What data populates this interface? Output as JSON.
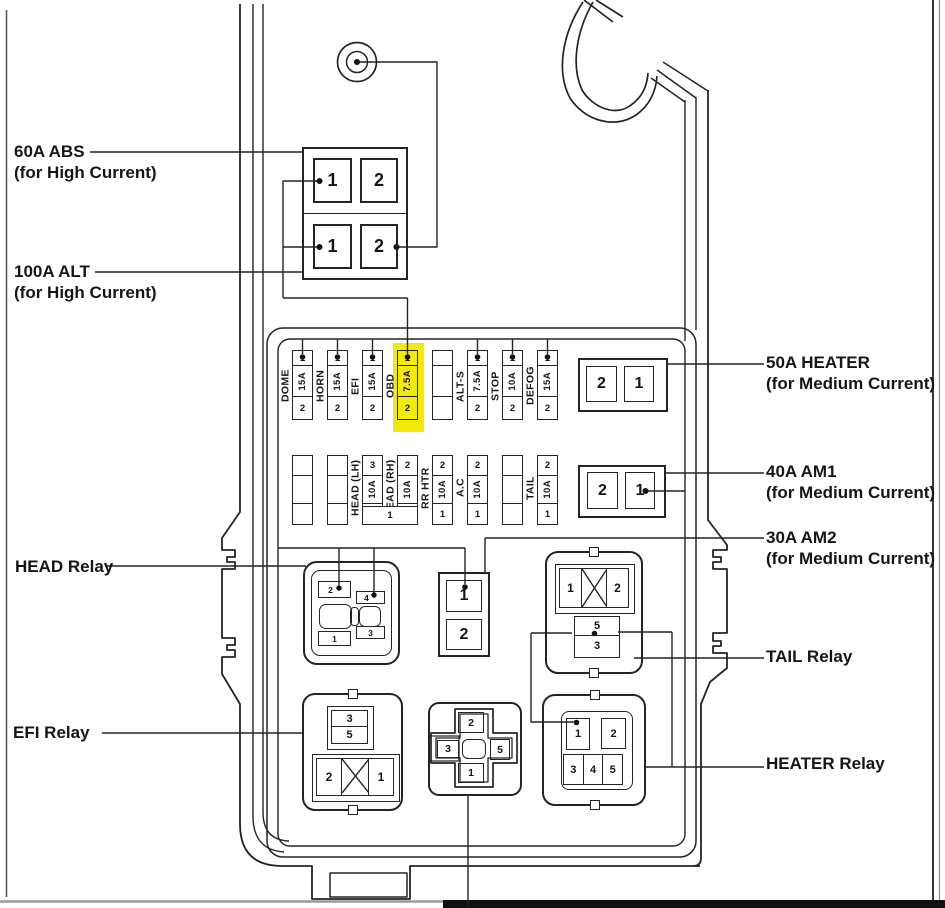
{
  "colors": {
    "highlight": "#f2e90e",
    "line": "#242424",
    "paper": "#ffffff"
  },
  "side_labels": {
    "abs_title": "60A ABS",
    "abs_sub": "(for High Current)",
    "alt_title": "100A ALT",
    "alt_sub": "(for High Current)",
    "heater50_title": "50A HEATER",
    "heater50_sub": "(for Medium Current)",
    "am1_title": "40A AM1",
    "am1_sub": "(for Medium Current)",
    "am2_title": "30A AM2",
    "am2_sub": "(for Medium Current)",
    "head_relay": "HEAD Relay",
    "efi_relay": "EFI Relay",
    "tail_relay": "TAIL Relay",
    "heater_relay": "HEATER Relay"
  },
  "high_current_block": {
    "r1c1": "1",
    "r1c2": "2",
    "r2c1": "1",
    "r2c2": "2"
  },
  "fuse_row_top": [
    {
      "name": "DOME",
      "top": "1",
      "amp": "15A",
      "bottom": "2"
    },
    {
      "name": "HORN",
      "top": "1",
      "amp": "15A",
      "bottom": "2"
    },
    {
      "name": "EFI",
      "top": "1",
      "amp": "15A",
      "bottom": "2"
    },
    {
      "name": "OBD",
      "top": "1",
      "amp": "7.5A",
      "bottom": "2",
      "highlighted": true
    },
    {
      "name": "",
      "top": "",
      "amp": "",
      "bottom": ""
    },
    {
      "name": "ALT-S",
      "top": "1",
      "amp": "7.5A",
      "bottom": "2"
    },
    {
      "name": "STOP",
      "top": "1",
      "amp": "10A",
      "bottom": "2"
    },
    {
      "name": "DEFOG",
      "top": "1",
      "amp": "15A",
      "bottom": "2"
    }
  ],
  "fuse_row_bottom": [
    {
      "name": "",
      "top": "",
      "amp": "",
      "bottom": ""
    },
    {
      "name": "",
      "top": "",
      "amp": "",
      "bottom": ""
    },
    {
      "name": "HEAD (LH)",
      "top": "3",
      "amp": "10A",
      "bottom": ""
    },
    {
      "name": "HEAD (RH)",
      "top": "2",
      "amp": "10A",
      "bottom": ""
    },
    {
      "name": "RR HTR",
      "top": "2",
      "amp": "10A",
      "bottom": "1"
    },
    {
      "name": "A.C",
      "top": "2",
      "amp": "10A",
      "bottom": "1"
    },
    {
      "name": "",
      "top": "",
      "amp": "",
      "bottom": ""
    },
    {
      "name": "TAIL",
      "top": "2",
      "amp": "10A",
      "bottom": "1"
    }
  ],
  "shared_head_fuse_pin": "1",
  "medium_blocks": {
    "heater50": {
      "left": "2",
      "right": "1"
    },
    "am1": {
      "left": "2",
      "right": "1"
    },
    "am2": {
      "top": "1",
      "bottom": "2"
    }
  },
  "head_relay": {
    "p2": "2",
    "p4": "4",
    "p1": "1",
    "p3": "3"
  },
  "tail_relay": {
    "left": "1",
    "right": "2",
    "coil_top": "5",
    "coil_bottom": "3"
  },
  "efi_relay": {
    "coil_top": "3",
    "coil_bottom": "5",
    "left": "2",
    "right": "1"
  },
  "cross_relay": {
    "top": "2",
    "left": "3",
    "right": "5",
    "bottom": "1"
  },
  "heater_relay": {
    "p1": "1",
    "p2": "2",
    "p3": "3",
    "p4": "4",
    "p5": "5"
  }
}
